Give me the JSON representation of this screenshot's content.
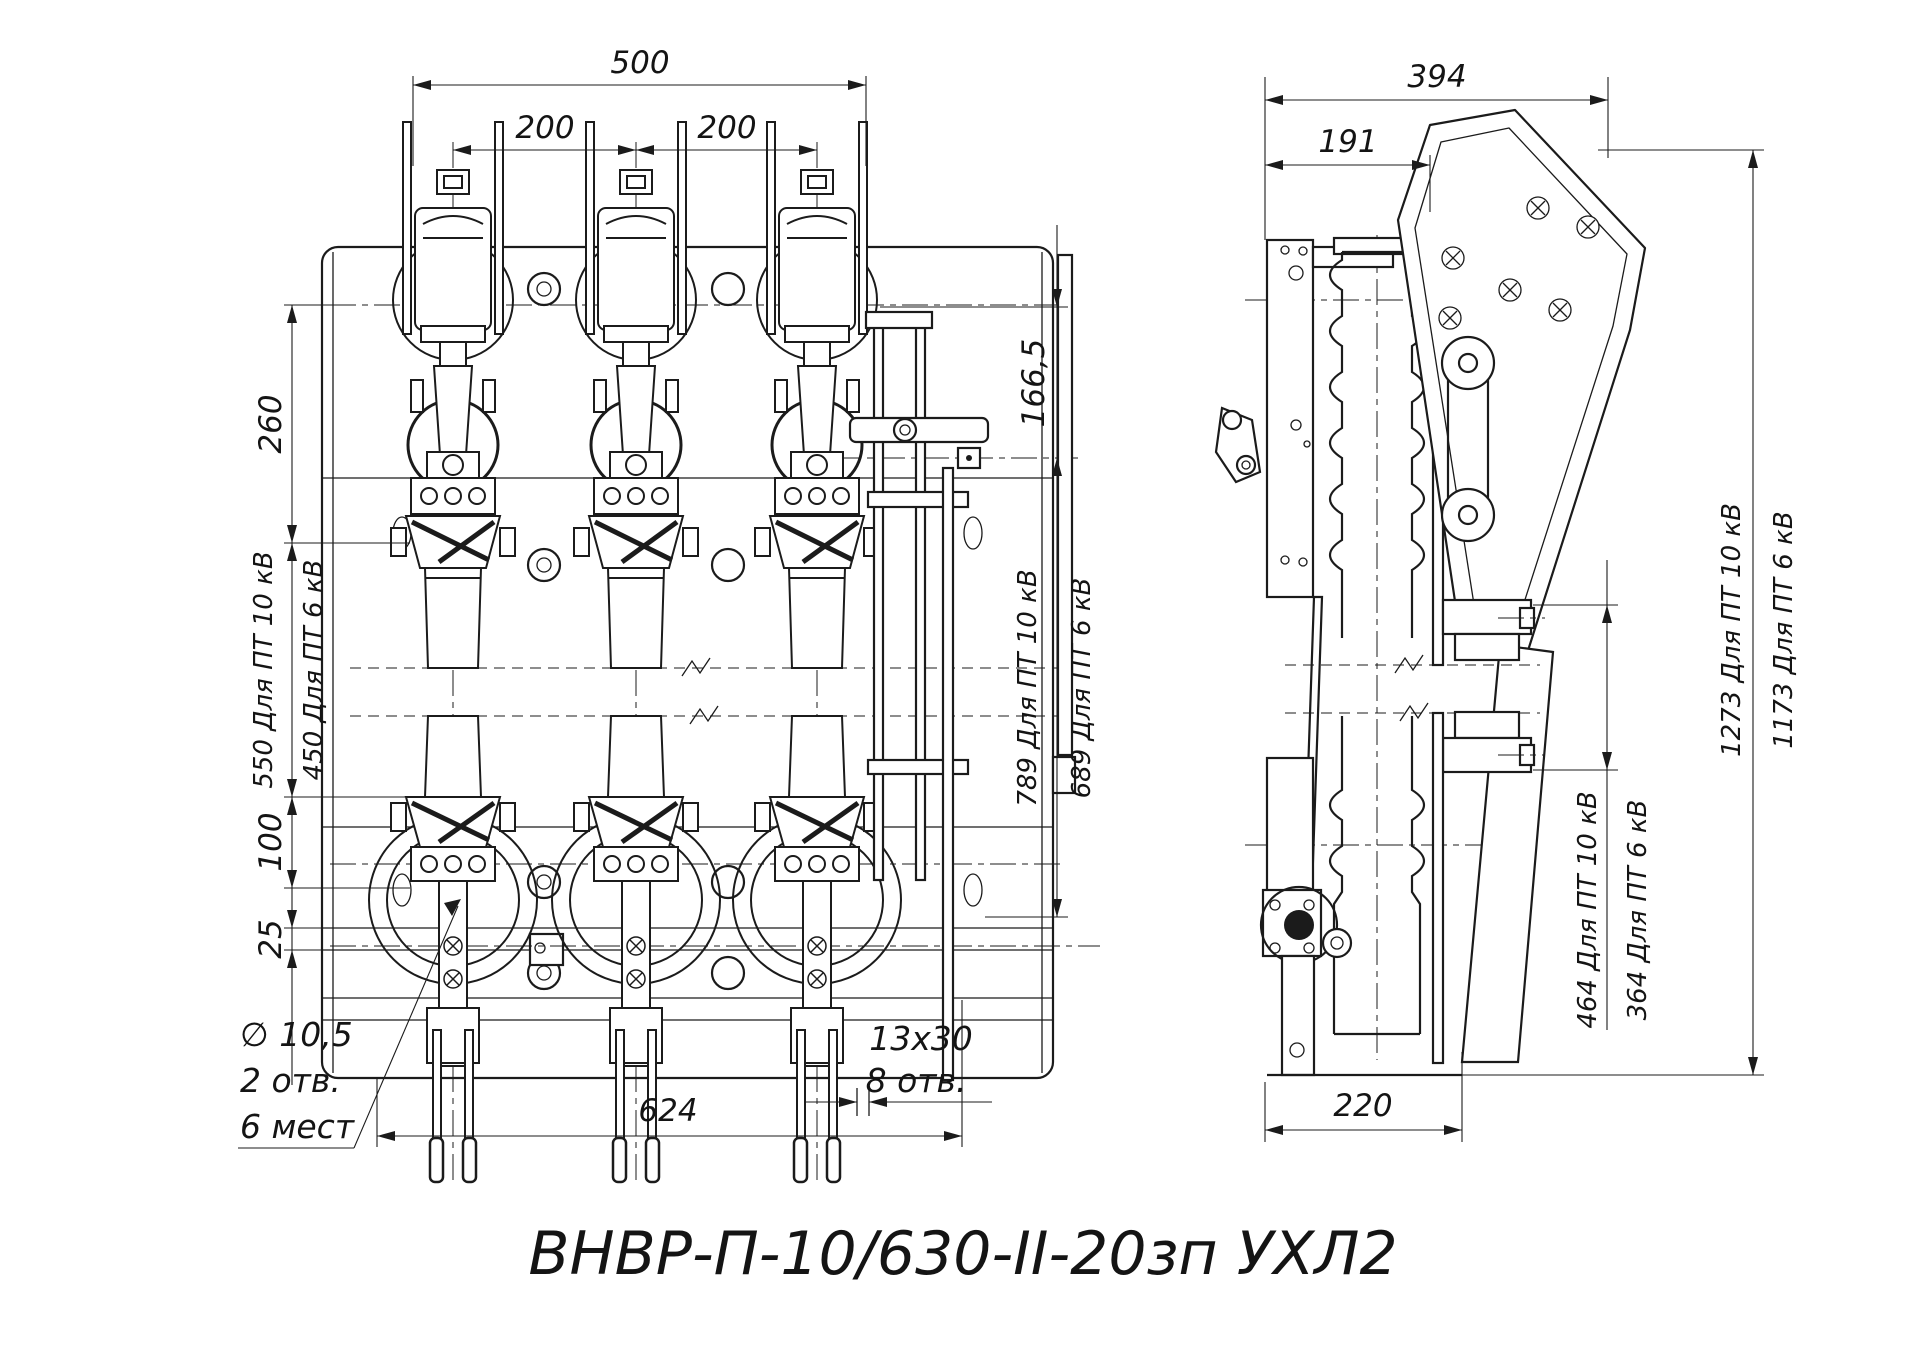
{
  "title": "ВНВР-П-10/630-II-20зп УХЛ2",
  "colors": {
    "line": "#1b1b1b",
    "background": "#ffffff"
  },
  "front_view": {
    "dim_overall_width": "500",
    "dim_pole_pitch_left": "200",
    "dim_pole_pitch_right": "200",
    "dim_top_offset": "260",
    "dim_upper_pt10": "550 Для ПТ 10 кВ",
    "dim_upper_pt6": "450 Для ПТ 6 кВ",
    "dim_clamp_height": "100",
    "dim_rail_gap": "25",
    "dim_shaft_offset": "166,5",
    "dim_height_pt10": "789 Для ПТ 10 кВ",
    "dim_height_pt6": "689 Для ПТ 6 кВ",
    "dim_base_width": "624",
    "slot_note_line1": "13x30",
    "slot_note_line2": "8 отв.",
    "hole_note_line1": "∅ 10,5",
    "hole_note_line2": "2 отв.",
    "hole_note_line3": "6 мест"
  },
  "side_view": {
    "dim_overall_depth": "394",
    "dim_plate_depth": "191",
    "dim_height_pt10": "1273 Для ПТ 10 кВ",
    "dim_height_pt6": "1173 Для ПТ 6 кВ",
    "dim_terminal_pt10": "464 Для ПТ 10 кВ",
    "dim_terminal_pt6": "364 Для ПТ 6 кВ",
    "dim_base_depth": "220"
  }
}
